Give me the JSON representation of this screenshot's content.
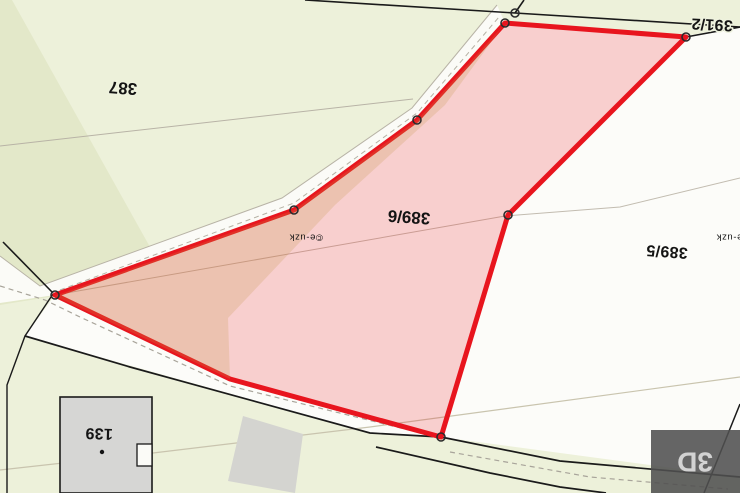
{
  "map_labels": {
    "parcel_387": "387",
    "parcel_391_2": "391/2",
    "parcel_389_6": "389/6",
    "parcel_389_5": "389/5",
    "building_139": "139"
  },
  "selection": {
    "selected_parcel": "389/6",
    "outline_color": "#e8151e",
    "fill_color": "rgba(237,28,36,0.20)"
  },
  "watermark": {
    "text": "©e-uzk"
  },
  "controls": {
    "view_3d": "3D"
  },
  "palette": {
    "land_green": "#edf1da",
    "land_green_dark": "#e3e8c9",
    "parcel_white": "#fcfcf9",
    "building_gray": "#d6d6d4",
    "boundary_black": "#1a1a1a",
    "boundary_gray": "#b8b3a6"
  }
}
